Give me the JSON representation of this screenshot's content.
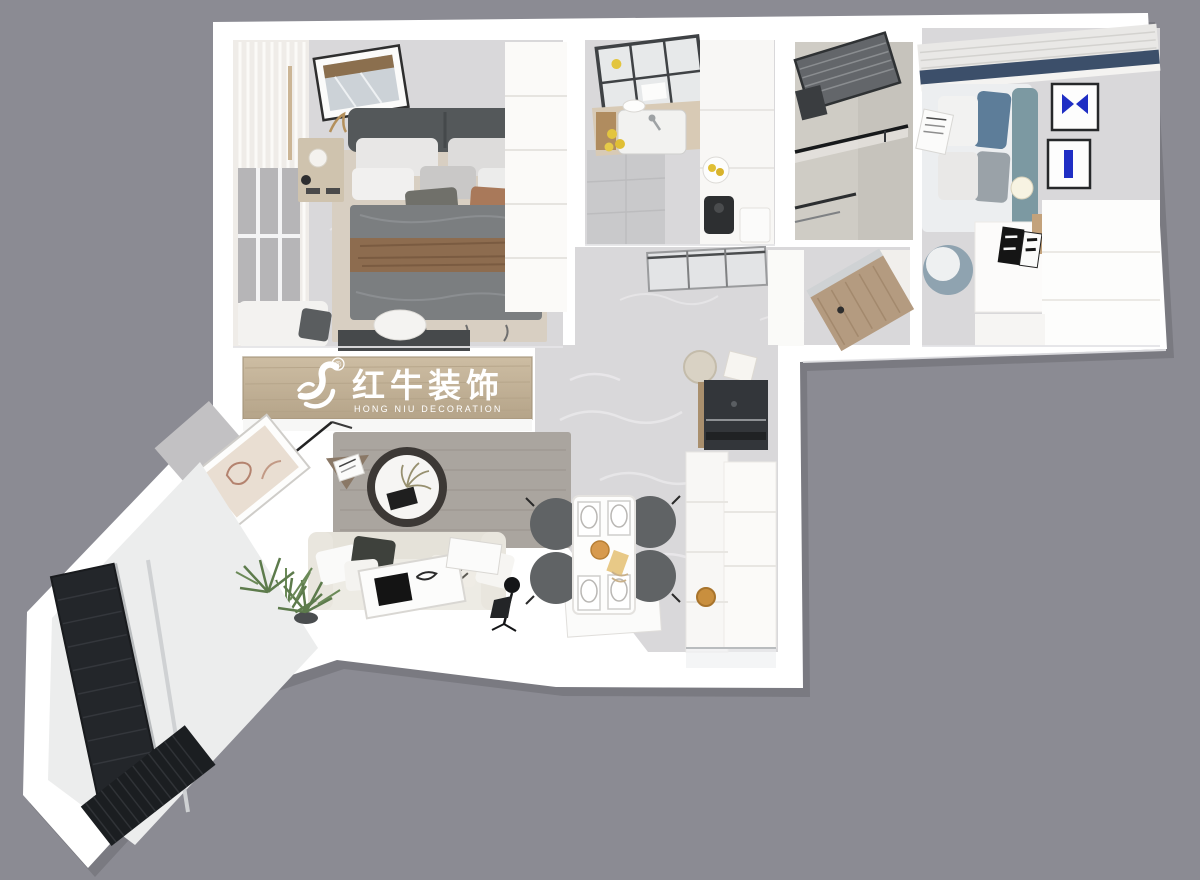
{
  "scene": {
    "type": "3d-apartment-floorplan-render",
    "colors": {
      "background": "#8b8b93",
      "wall": "#ffffff",
      "floor_marble": "#d9d8da",
      "floor_light": "#f1f0f2",
      "wood_plaque": "#c4b399",
      "logo_text": "#ffffff",
      "bed_blanket": "#7b7e80",
      "throw_brown": "#8d6c4f",
      "rug_beige": "#d8cfc2",
      "rug_gray": "#aaa59f",
      "sofa_cream": "#edebe4",
      "chair_dark": "#606365",
      "accent_blue": "#1f2ec4",
      "teal_headboard": "#7c99a2",
      "curtain_blue": "#3c4f6a",
      "panel_dark": "#23262a",
      "plant_green": "#5d7b4c",
      "amber": "#d79a4e"
    }
  },
  "logo": {
    "icon": "bull-swoosh-logo-icon",
    "registered_mark": "®",
    "brand_cn": "红牛装饰",
    "brand_en": "HONG NIU DECORATION"
  }
}
